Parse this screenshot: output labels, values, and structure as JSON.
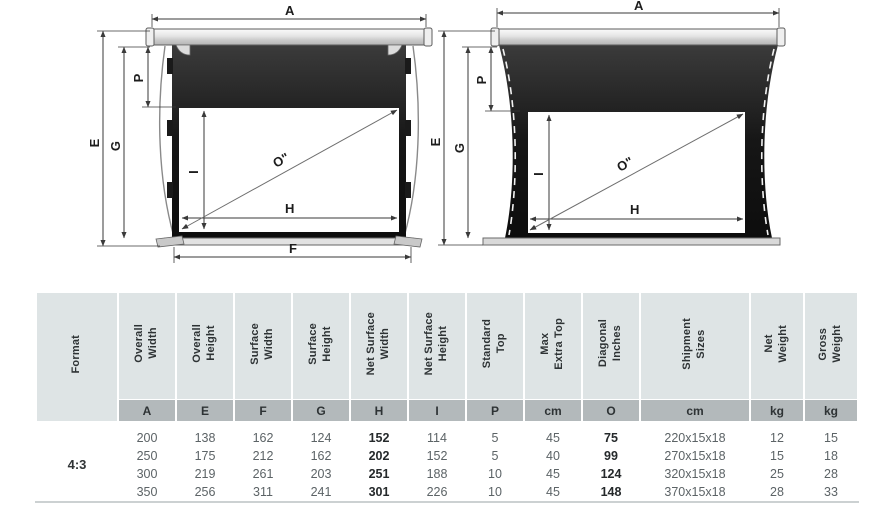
{
  "diagrams": {
    "left": {
      "labels": {
        "a": "A",
        "p": "P",
        "e": "E",
        "g": "G",
        "i": "I",
        "o": "O\"",
        "h": "H",
        "f": "F"
      }
    },
    "right": {
      "labels": {
        "a": "A",
        "p": "P",
        "e": "E",
        "g": "G",
        "i": "I",
        "o": "O\"",
        "h": "H"
      }
    }
  },
  "colors": {
    "header_bg": "#dee4e5",
    "subheader_bg": "#b3b9bb",
    "fabric_black": "#161616",
    "dim_line": "#555555",
    "data_text": "#5c6366",
    "bold_text": "#25292b"
  },
  "table": {
    "format_label": "4:3",
    "columns": [
      {
        "label": "Format",
        "letter": ""
      },
      {
        "label": "Overall\nWidth",
        "letter": "A"
      },
      {
        "label": "Overall\nHeight",
        "letter": "E"
      },
      {
        "label": "Surface\nWidth",
        "letter": "F"
      },
      {
        "label": "Surface\nHeight",
        "letter": "G"
      },
      {
        "label": "Net Surface\nWidth",
        "letter": "H"
      },
      {
        "label": "Net Surface\nHeight",
        "letter": "I"
      },
      {
        "label": "Standard\nTop",
        "letter": "P"
      },
      {
        "label": "Max\nExtra Top",
        "letter": "cm"
      },
      {
        "label": "Diagonal\nInches",
        "letter": "O"
      },
      {
        "label": "Shipment\nSizes",
        "letter": "cm"
      },
      {
        "label": "Net\nWeight",
        "letter": "kg"
      },
      {
        "label": "Gross\nWeight",
        "letter": "kg"
      }
    ],
    "rows": [
      [
        "200",
        "138",
        "162",
        "124",
        "152",
        "114",
        "5",
        "45",
        "75",
        "220x15x18",
        "12",
        "15"
      ],
      [
        "250",
        "175",
        "212",
        "162",
        "202",
        "152",
        "5",
        "40",
        "99",
        "270x15x18",
        "15",
        "18"
      ],
      [
        "300",
        "219",
        "261",
        "203",
        "251",
        "188",
        "10",
        "45",
        "124",
        "320x15x18",
        "25",
        "28"
      ],
      [
        "350",
        "256",
        "311",
        "241",
        "301",
        "226",
        "10",
        "45",
        "148",
        "370x15x18",
        "28",
        "33"
      ]
    ]
  }
}
